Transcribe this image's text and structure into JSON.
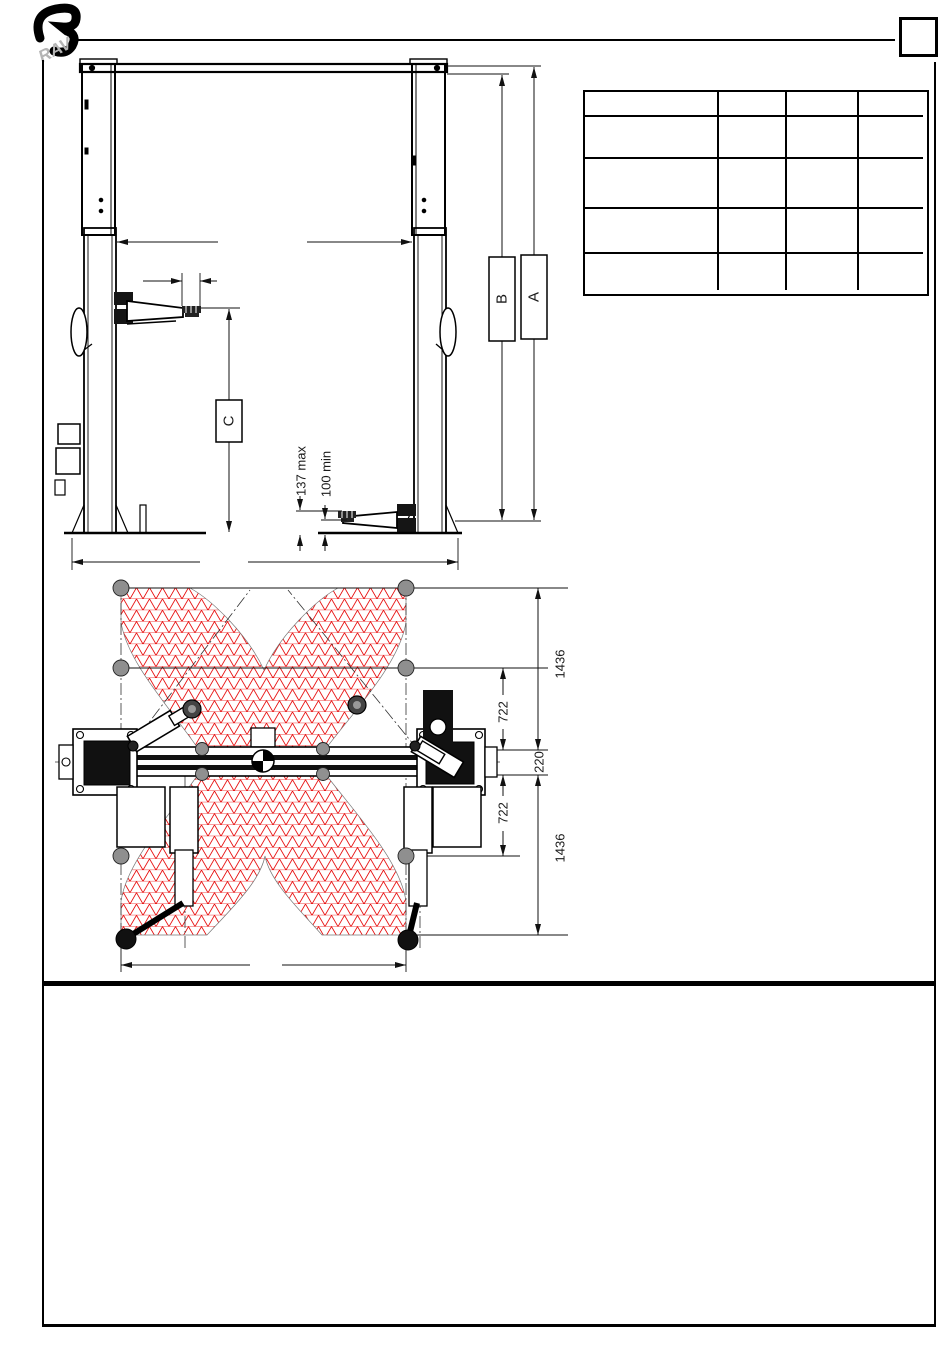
{
  "header": {
    "logo_text": "RAV"
  },
  "spec_table": {
    "rows": 5,
    "columns": 4
  },
  "front_view": {
    "label_a": "A",
    "label_b": "B",
    "label_c": "C",
    "pad_height_max": "137 max",
    "pad_height_min": "100 min"
  },
  "plan_view": {
    "dim_outer_top": "1436",
    "dim_inner_top": "722",
    "dim_center": "220",
    "dim_inner_bottom": "722",
    "dim_outer_bottom": "1436",
    "hatch_color": "#e60000"
  }
}
